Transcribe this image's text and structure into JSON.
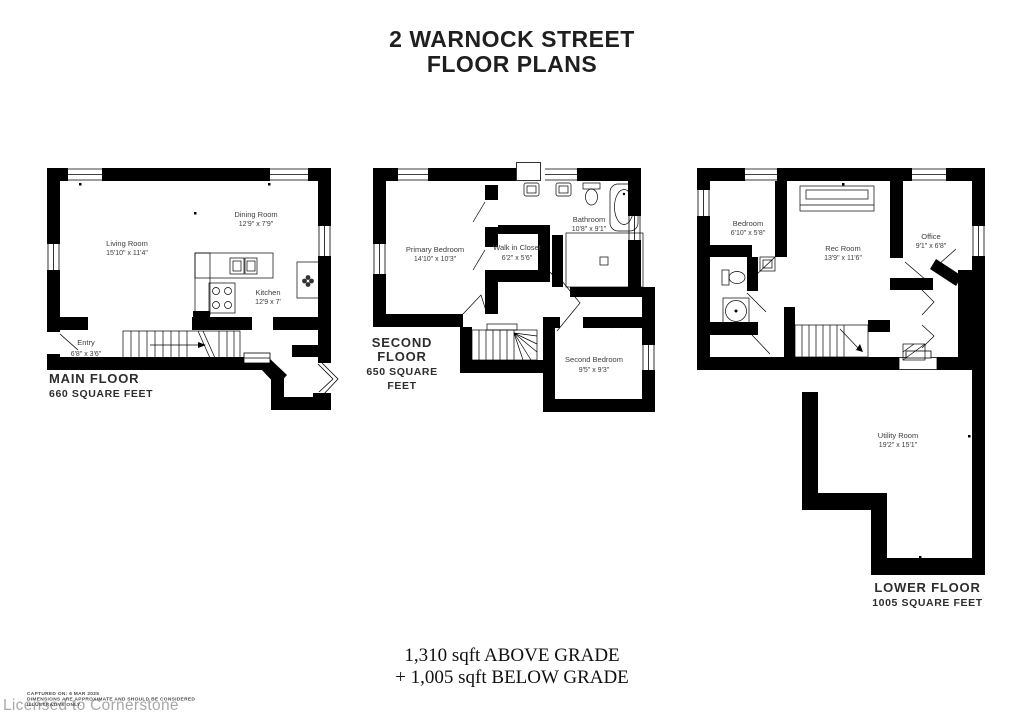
{
  "title": {
    "line1": "2 WARNOCK STREET",
    "line2": "FLOOR PLANS"
  },
  "floors": {
    "main": {
      "label": "MAIN FLOOR",
      "area": "660 SQUARE FEET",
      "rooms": {
        "living": {
          "name": "Living Room",
          "dims": "15'10\" x 11'4\""
        },
        "dining": {
          "name": "Dining Room",
          "dims": "12'9\" x 7'9\""
        },
        "kitchen": {
          "name": "Kitchen",
          "dims": "12'9 x 7'"
        },
        "entry": {
          "name": "Entry",
          "dims": "6'8\" x 3'6\""
        }
      }
    },
    "second": {
      "label": "SECOND FLOOR",
      "area": "650 SQUARE FEET",
      "rooms": {
        "primary": {
          "name": "Primary Bedroom",
          "dims": "14'10\" x 10'3\""
        },
        "closet": {
          "name": "Walk in Closet",
          "dims": "6'2\" x 5'6\""
        },
        "bathroom": {
          "name": "Bathroom",
          "dims": "10'8\" x 9'1\""
        },
        "second_bedroom": {
          "name": "Second Bedroom",
          "dims": "9'5\" x 9'3\""
        }
      }
    },
    "lower": {
      "label": "LOWER FLOOR",
      "area": "1005 SQUARE FEET",
      "rooms": {
        "bedroom": {
          "name": "Bedroom",
          "dims": "6'10\" x 5'8\""
        },
        "rec_room": {
          "name": "Rec Room",
          "dims": "13'9\" x 11'6\""
        },
        "office": {
          "name": "Office",
          "dims": "9'1\" x 6'8\""
        },
        "utility": {
          "name": "Utility Room",
          "dims": "19'2\" x 15'1\""
        }
      }
    }
  },
  "summary": {
    "line1": "1,310 sqft ABOVE GRADE",
    "line2": "+ 1,005 sqft BELOW GRADE"
  },
  "disclaimer": {
    "line1": "CAPTURED ON: 6 MAR 2025",
    "line2": "DIMENSIONS ARE APPROXIMATE AND SHOULD BE CONSIDERED",
    "line3": "ILLUSTRATIVE ONLY."
  },
  "watermark": "Licensed to Cornerstone",
  "icons": [
    "stove-icon",
    "sink-icon",
    "toilet-icon",
    "bathtub-icon",
    "shower-icon",
    "fan-icon",
    "stairs",
    "window",
    "door"
  ],
  "colors": {
    "wall": "#000000",
    "background": "#ffffff",
    "label_text": "#3d3d3d",
    "watermark_text": "#a9a9a9"
  }
}
